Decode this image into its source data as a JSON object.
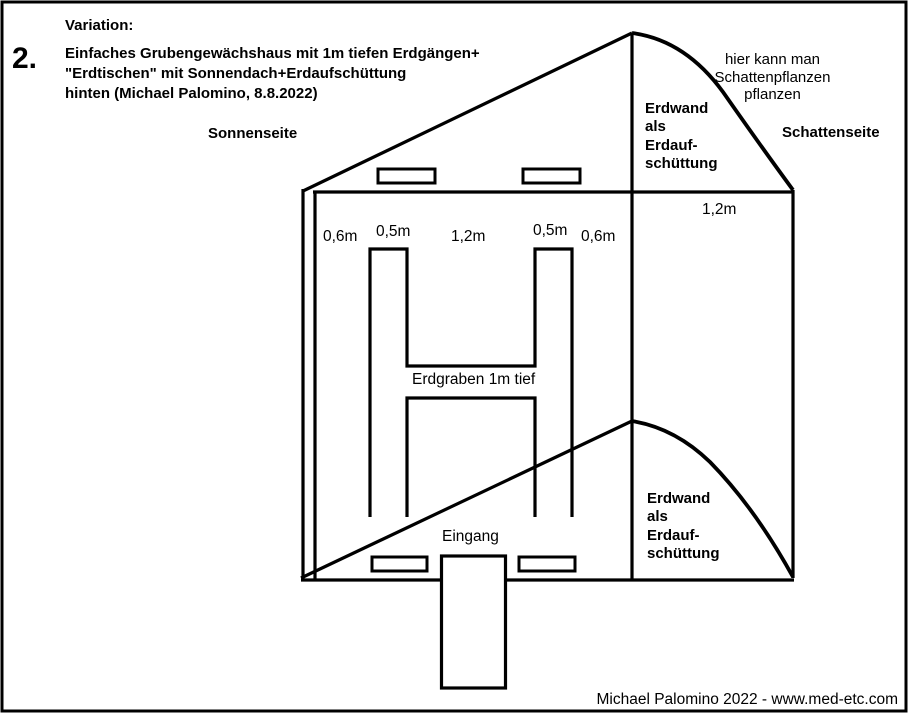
{
  "figure": {
    "number": "2.",
    "variation_label": "Variation:",
    "title": "Einfaches Grubengewächshaus mit 1m tiefen Erdgängen+\n\"Erdtischen\" mit Sonnendach+Erdaufschüttung\nhinten (Michael Palomino, 8.8.2022)"
  },
  "labels": {
    "sun_side": "Sonnenseite",
    "shade_side": "Schattenseite",
    "shade_plants_note": "hier kann man\nSchattenpflanzen\npflanzen",
    "earth_wall_top": "Erdwand\nals\nErdauf-\nschüttung",
    "earth_wall_bottom": "Erdwand\nals\nErdauf-\nschüttung",
    "trench": "Erdgraben 1m tief",
    "entrance": "Eingang"
  },
  "measurements": {
    "left_edge": "0,6m",
    "left_trench": "0,5m",
    "center": "1,2m",
    "right_trench": "0,5m",
    "right_edge": "0,6m",
    "earth_wall_width": "1,2m"
  },
  "footer": {
    "credit": "Michael Palomino 2022 - www.med-etc.com"
  },
  "colors": {
    "line": "#000000",
    "background": "#ffffff"
  }
}
